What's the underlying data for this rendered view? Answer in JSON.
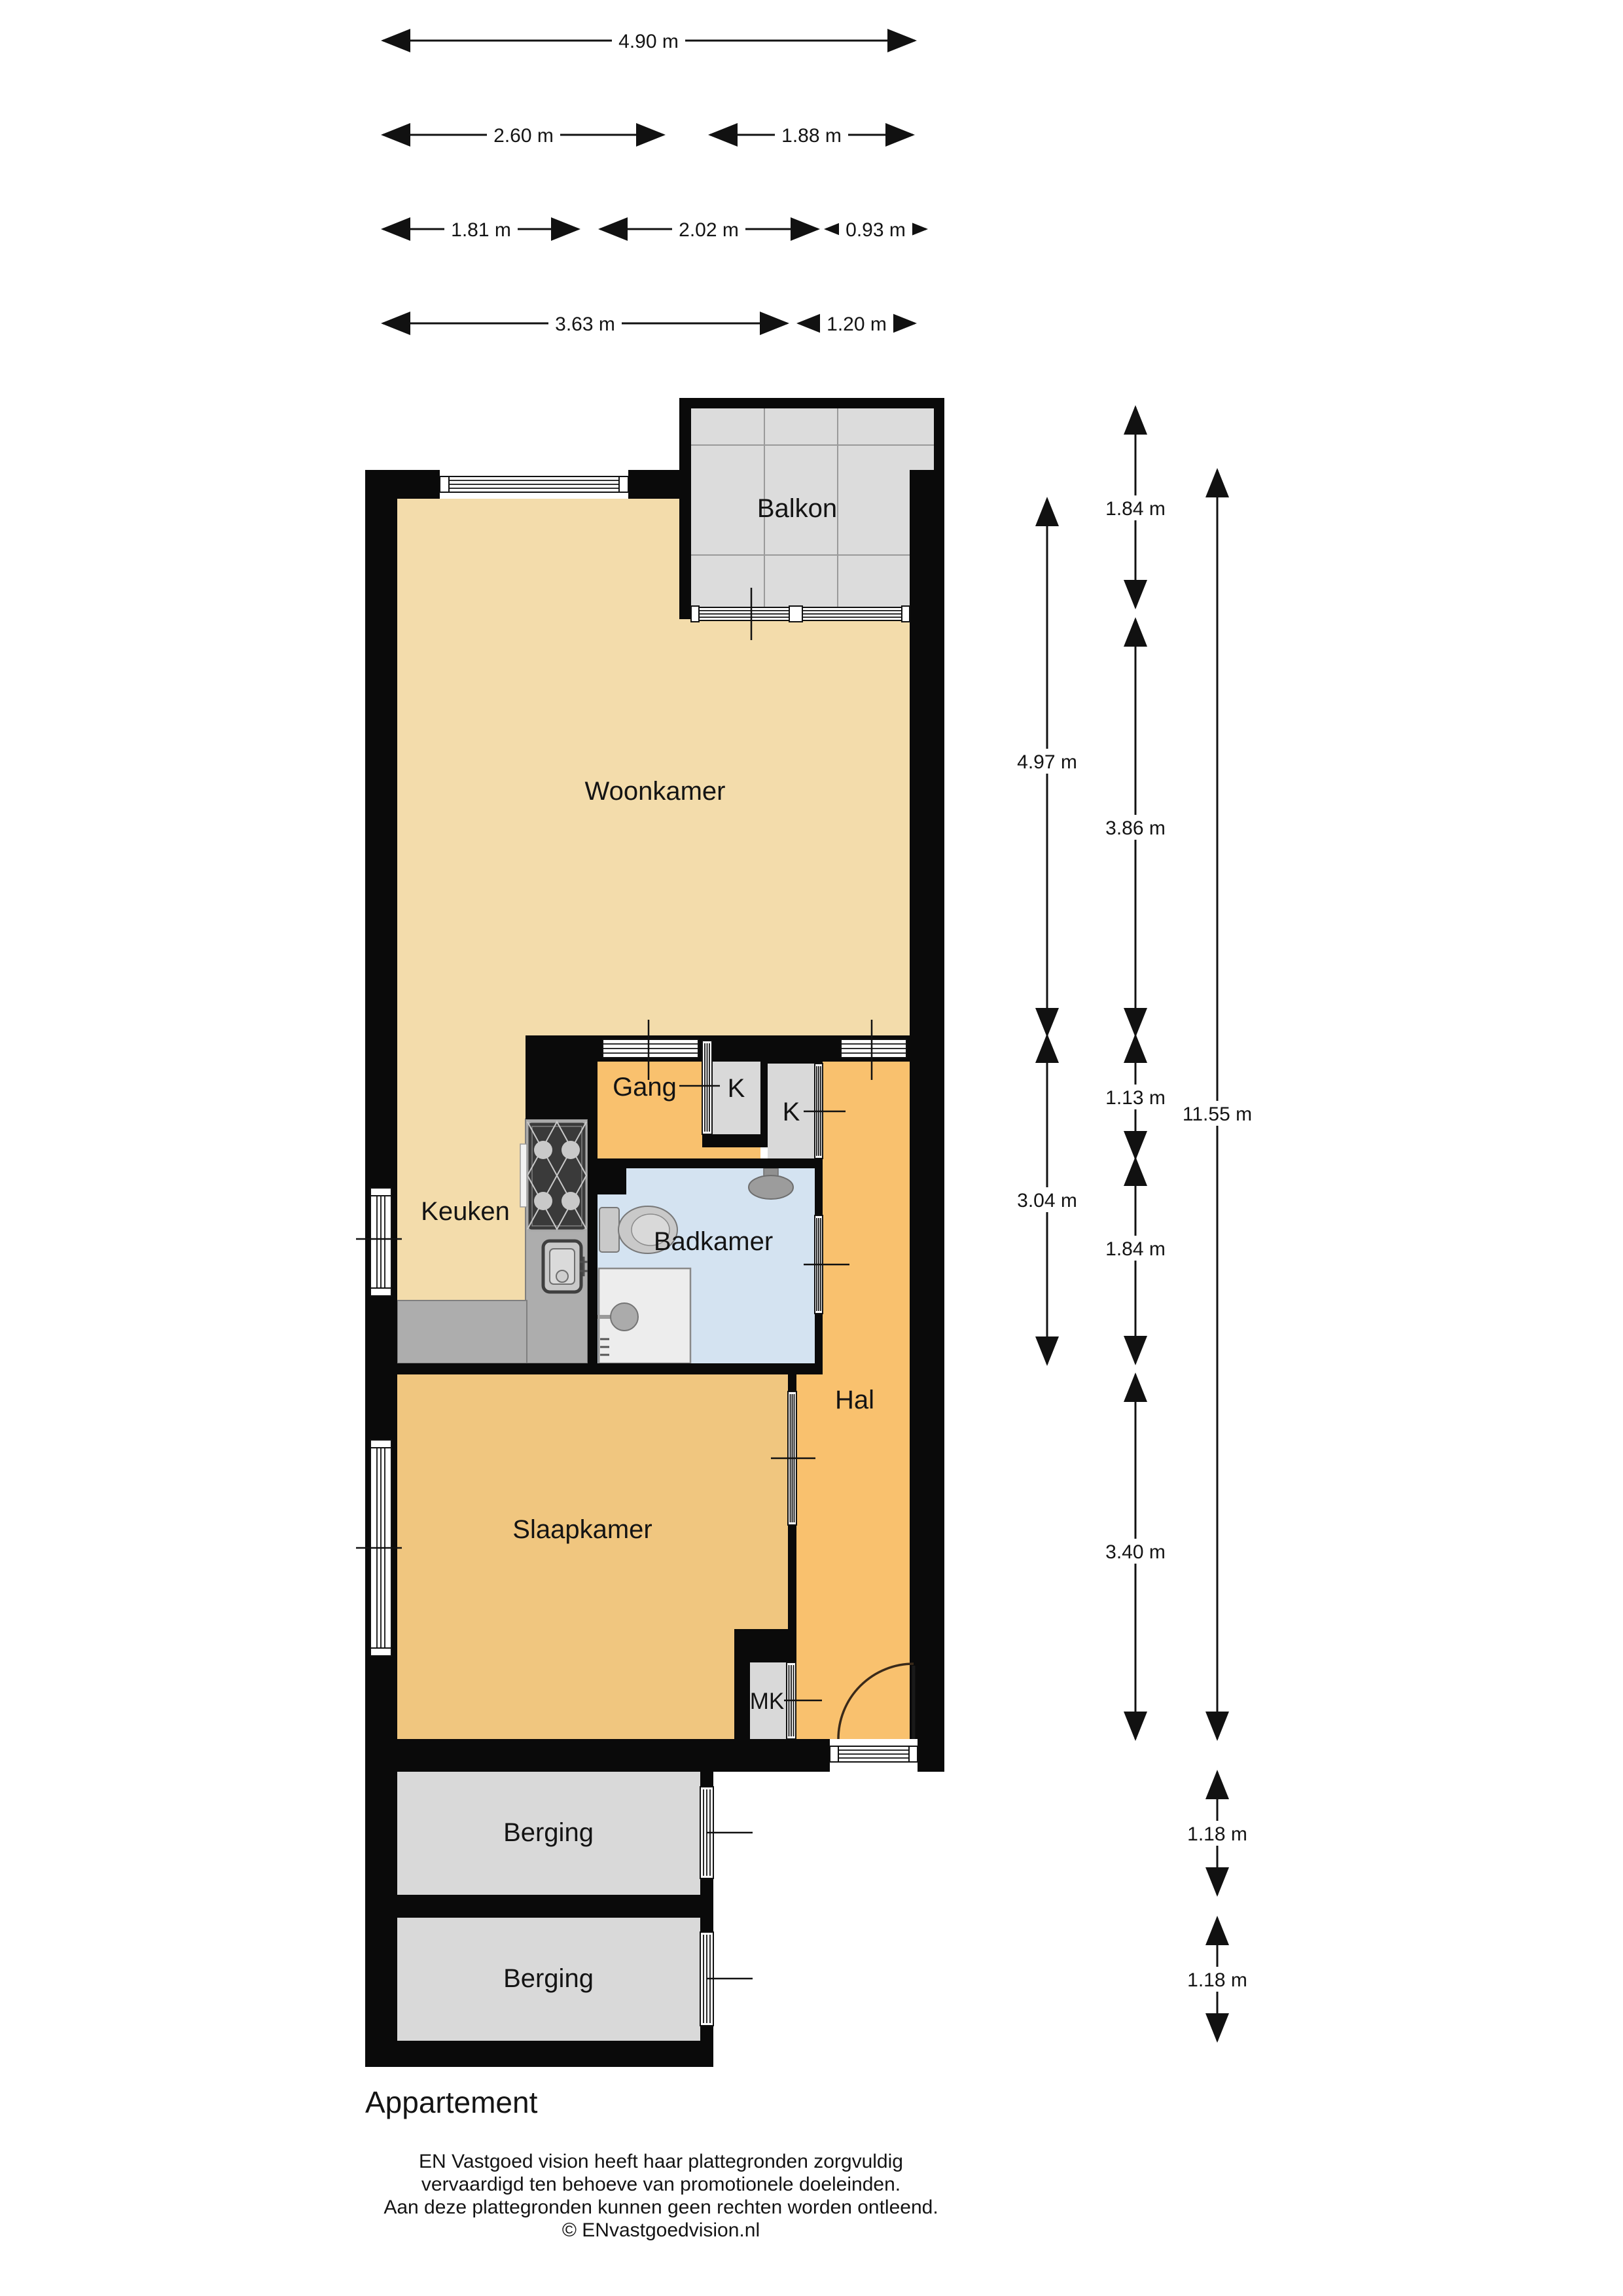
{
  "title": "Appartement",
  "rooms": {
    "balkon": "Balkon",
    "woonkamer": "Woonkamer",
    "gang": "Gang",
    "kast1": "K",
    "kast2": "K",
    "keuken": "Keuken",
    "badkamer": "Badkamer",
    "hal": "Hal",
    "slaapkamer": "Slaapkamer",
    "mk": "MK",
    "berging1": "Berging",
    "berging2": "Berging"
  },
  "dimensions": {
    "top": [
      {
        "label": "4.90 m"
      },
      {
        "label": "2.60 m"
      },
      {
        "label": "1.88 m"
      },
      {
        "label": "1.81 m"
      },
      {
        "label": "2.02 m"
      },
      {
        "label": "0.93 m"
      },
      {
        "label": "3.63 m"
      },
      {
        "label": "1.20 m"
      }
    ],
    "right": [
      {
        "label": "1.84 m"
      },
      {
        "label": "4.97 m"
      },
      {
        "label": "3.86 m"
      },
      {
        "label": "1.13 m"
      },
      {
        "label": "11.55 m"
      },
      {
        "label": "3.04 m"
      },
      {
        "label": "1.84 m"
      },
      {
        "label": "3.40 m"
      },
      {
        "label": "1.18 m"
      },
      {
        "label": "1.18 m"
      }
    ]
  },
  "footer": {
    "line1": "EN Vastgoed vision heeft haar plattegronden zorgvuldig",
    "line2": "vervaardigd ten behoeve van promotionele doeleinden.",
    "line3": "Aan deze plattegronden kunnen geen rechten worden ontleend.",
    "line4": "© ENvastgoedvision.nl"
  },
  "colors": {
    "wall": "#0a0a0a",
    "living_tan": "#F3DCAB",
    "hall_orange": "#F9C16E",
    "bedroom_orange": "#F0C67F",
    "bathroom_blue": "#D4E3F1",
    "storage_gray": "#D9D9D9",
    "balcony_gray": "#DCDCDC",
    "counter_gray": "#ADADAD"
  }
}
